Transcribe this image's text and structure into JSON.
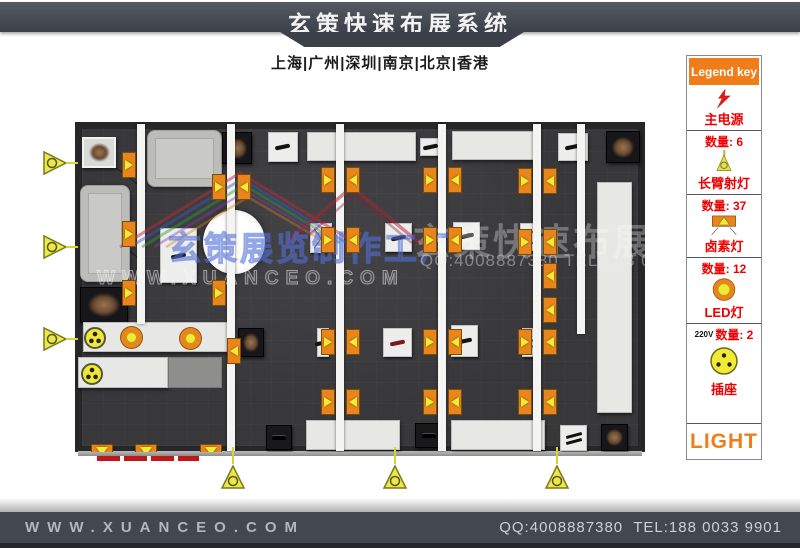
{
  "header": {
    "title": "玄策快速布展系统",
    "subtitle": "上海|广州|深圳|南京|北京|香港"
  },
  "legend": {
    "title": "Legend key",
    "items": [
      {
        "id": "main-power",
        "label": "主电源",
        "icon": "lightning-icon"
      },
      {
        "id": "long-arm-spotlight",
        "label": "长臂射灯",
        "qty_label": "数量: 6",
        "icon": "spotlight-icon"
      },
      {
        "id": "halogen-lamp",
        "label": "卤素灯",
        "qty_label": "数量: 37",
        "icon": "halogen-icon"
      },
      {
        "id": "led-lamp",
        "label": "LED灯",
        "qty_label": "数量: 12",
        "icon": "led-icon"
      },
      {
        "id": "power-socket",
        "label": "插座",
        "qty_label": "数量: 2",
        "voltage": "220V",
        "icon": "socket-icon"
      }
    ],
    "footer_label": "LIGHT"
  },
  "watermarks": {
    "brand_cn": "玄策展览制作工厂",
    "brand_url": "WWW.XUANCEO.COM",
    "title_cn": "玄策快速布展系统",
    "contact": "QQ:4008887380 TEL:188 003"
  },
  "footer": {
    "website": "WWW.XUANCEO.COM",
    "contact": "QQ:4008887380  TEL:188 0033 9901"
  },
  "floorplan": {
    "strips": [
      [
        62,
        2,
        8,
        200
      ],
      [
        152,
        2,
        8,
        327
      ],
      [
        261,
        2,
        8,
        327
      ],
      [
        363,
        2,
        8,
        327
      ],
      [
        458,
        2,
        8,
        327
      ],
      [
        502,
        2,
        8,
        210
      ]
    ],
    "halogen_markers": [
      [
        47,
        30,
        "r"
      ],
      [
        47,
        99,
        "r"
      ],
      [
        47,
        158,
        "r"
      ],
      [
        137,
        52,
        "r"
      ],
      [
        162,
        52,
        "l"
      ],
      [
        137,
        158,
        "r"
      ],
      [
        152,
        216,
        "l"
      ],
      [
        246,
        45,
        "r"
      ],
      [
        271,
        45,
        "l"
      ],
      [
        246,
        105,
        "r"
      ],
      [
        271,
        105,
        "l"
      ],
      [
        246,
        207,
        "r"
      ],
      [
        271,
        207,
        "l"
      ],
      [
        246,
        267,
        "r"
      ],
      [
        271,
        267,
        "l"
      ],
      [
        348,
        45,
        "r"
      ],
      [
        373,
        45,
        "l"
      ],
      [
        348,
        105,
        "r"
      ],
      [
        373,
        105,
        "l"
      ],
      [
        348,
        207,
        "r"
      ],
      [
        373,
        207,
        "l"
      ],
      [
        348,
        267,
        "r"
      ],
      [
        373,
        267,
        "l"
      ],
      [
        443,
        46,
        "r"
      ],
      [
        468,
        46,
        "l"
      ],
      [
        443,
        107,
        "r"
      ],
      [
        468,
        107,
        "l"
      ],
      [
        468,
        141,
        "l"
      ],
      [
        468,
        175,
        "l"
      ],
      [
        443,
        207,
        "r"
      ],
      [
        468,
        207,
        "l"
      ],
      [
        443,
        267,
        "r"
      ],
      [
        468,
        267,
        "l"
      ],
      [
        16,
        322,
        "d"
      ],
      [
        60,
        322,
        "d"
      ],
      [
        125,
        322,
        "d"
      ]
    ],
    "furniture": [
      [
        7,
        15,
        34,
        31,
        "artl"
      ],
      [
        72,
        8,
        75,
        57,
        "sofa"
      ],
      [
        147,
        10,
        30,
        32,
        "artd"
      ],
      [
        193,
        10,
        30,
        30,
        "ped"
      ],
      [
        232,
        10,
        109,
        29,
        "counter"
      ],
      [
        345,
        16,
        22,
        18,
        "ped"
      ],
      [
        377,
        9,
        86,
        29,
        "counter"
      ],
      [
        483,
        11,
        30,
        28,
        "ped"
      ],
      [
        531,
        9,
        34,
        32,
        "artd"
      ],
      [
        522,
        60,
        35,
        231,
        "counter"
      ],
      [
        5,
        63,
        50,
        97,
        "sofa"
      ],
      [
        5,
        165,
        48,
        36,
        "artd"
      ],
      [
        8,
        200,
        147,
        30,
        "counter"
      ],
      [
        3,
        235,
        90,
        31,
        "counter"
      ],
      [
        93,
        235,
        54,
        31,
        "block"
      ],
      [
        85,
        106,
        37,
        55,
        "ped"
      ],
      [
        128,
        88,
        62,
        64,
        "circle"
      ],
      [
        163,
        206,
        26,
        29,
        "artd"
      ],
      [
        235,
        101,
        22,
        30,
        "pedx"
      ],
      [
        310,
        101,
        27,
        29,
        "ped"
      ],
      [
        378,
        100,
        27,
        28,
        "ped"
      ],
      [
        445,
        101,
        18,
        28,
        "pedx"
      ],
      [
        242,
        206,
        12,
        29,
        "ped"
      ],
      [
        308,
        206,
        29,
        29,
        "pedr"
      ],
      [
        376,
        203,
        27,
        32,
        "ped"
      ],
      [
        447,
        206,
        16,
        29,
        "pedx"
      ],
      [
        191,
        303,
        26,
        25,
        "pedd"
      ],
      [
        231,
        298,
        94,
        30,
        "counter"
      ],
      [
        340,
        301,
        27,
        25,
        "pedd"
      ],
      [
        376,
        298,
        94,
        30,
        "counter"
      ],
      [
        485,
        303,
        27,
        26,
        "pedl"
      ],
      [
        526,
        302,
        27,
        27,
        "artd"
      ]
    ],
    "round_fixtures": [
      [
        20,
        216,
        "socket"
      ],
      [
        57,
        216,
        "led"
      ],
      [
        116,
        217,
        "led"
      ],
      [
        17,
        252,
        "socket"
      ]
    ],
    "spotlights": [
      [
        42,
        150,
        "right"
      ],
      [
        42,
        234,
        "right"
      ],
      [
        42,
        326,
        "right"
      ],
      [
        220,
        464,
        "up"
      ],
      [
        382,
        464,
        "up"
      ],
      [
        544,
        464,
        "up"
      ]
    ],
    "red_strips": [
      [
        97,
        456,
        23
      ],
      [
        124,
        456,
        23
      ],
      [
        151,
        456,
        23
      ],
      [
        178,
        456,
        21
      ]
    ]
  }
}
